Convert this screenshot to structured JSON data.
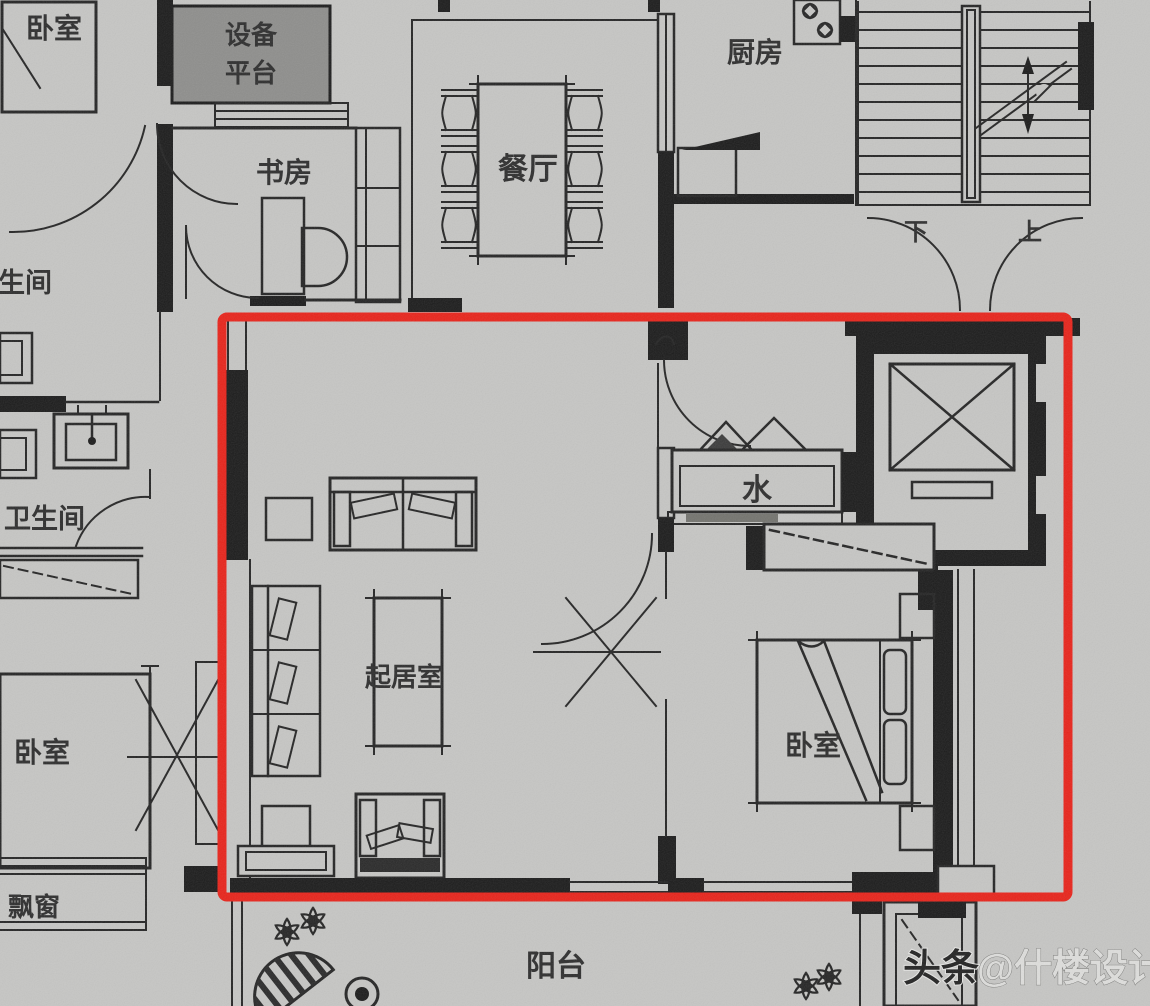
{
  "palette": {
    "background": "#c6c6c4",
    "ink": "#1c1c1c",
    "equipment_platform_fill": "#8e8e8c",
    "highlight_red": "#e8241b",
    "watermark_dark": "#232323",
    "watermark_light": "#dededc"
  },
  "rooms": {
    "bedroom_top_left": "卧室",
    "equipment_platform_line1": "设备",
    "equipment_platform_line2": "平台",
    "study": "书房",
    "dining": "餐厅",
    "kitchen": "厨房",
    "bathroom_partial": "生间",
    "bathroom": "卫生间",
    "living_room": "起居室",
    "water": "水",
    "bedroom_right": "卧室",
    "bedroom_bottom_left": "卧室",
    "bay_window": "飘窗",
    "balcony": "阳台"
  },
  "stairs": {
    "down": "下",
    "up": "上"
  },
  "watermark": {
    "brand": "头条",
    "handle": "@什楼设计"
  }
}
